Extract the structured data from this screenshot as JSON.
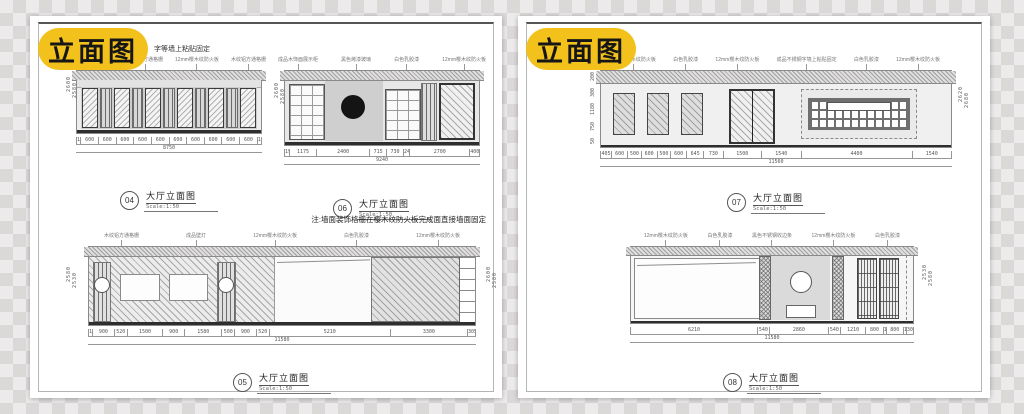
{
  "colors": {
    "badge_bg": "#F2C11B",
    "badge_text": "#161616",
    "paper": "#FFFFFF"
  },
  "left_page": {
    "badge": "立面图",
    "header_note": "字等墙上粘贴固定",
    "note": "注:墙面装饰格栅在樱木纹防火板完成面直接墙面固定",
    "drawing_04": {
      "number": "04",
      "title": "大厅立面图",
      "scale": "Scale:1:50",
      "dims": [
        "120",
        "600",
        "600",
        "600",
        "600",
        "600",
        "600",
        "600",
        "600",
        "600",
        "600",
        "120"
      ],
      "total_dim": "8750",
      "vdim_a": "2600",
      "vdim_b": "2580",
      "annotations": [
        "12mm樱木纹防火板",
        "木纹铝方通格栅",
        "12mm樱木纹防火板",
        "木纹铝方通格栅"
      ]
    },
    "drawing_06": {
      "number": "06",
      "title": "大厅立面图",
      "scale": "Scale:1:50",
      "dims": [
        "190",
        "1175",
        "2400",
        "715",
        "730",
        "240",
        "2700",
        "400"
      ],
      "total_dim": "9240",
      "vdim_a": "2600",
      "vdim_b": "2580",
      "annotations": [
        "成品木饰面展示柜",
        "黑色烤漆玻璃",
        "白色乳胶漆",
        "12mm樱木纹防火板"
      ]
    },
    "drawing_05": {
      "number": "05",
      "title": "大厅立面图",
      "scale": "Scale:1:50",
      "dims": [
        "130",
        "900",
        "520",
        "1500",
        "900",
        "1580",
        "500",
        "900",
        "520",
        "5210",
        "3300",
        "305"
      ],
      "total_dim": "11580",
      "vdim_left_a": "2580",
      "vdim_left_b": "2530",
      "vdim_right_a": "2600",
      "vdim_right_b": "2580",
      "annotations": [
        "木纹铝方通格栅",
        "成品壁灯",
        "12mm樱木纹防火板",
        "白色乳胶漆",
        "12mm樱木纹防火板"
      ]
    }
  },
  "right_page": {
    "badge": "立面图",
    "drawing_07": {
      "number": "07",
      "title": "大厅立面图",
      "scale": "Scale:1:50",
      "dims": [
        "405",
        "600",
        "500",
        "600",
        "500",
        "600",
        "645",
        "730",
        "1500",
        "1540",
        "4400",
        "1540"
      ],
      "total_dim": "11560",
      "vdims_left": [
        "200",
        "300",
        "1180",
        "750",
        "50"
      ],
      "vdim_a": "2620",
      "vdim_b": "2680",
      "annotations": [
        "12mm樱木纹防火板",
        "白色乳胶漆",
        "12mm樱木纹防火板",
        "成品不锈钢字墙上粘贴固定",
        "白色乳胶漆",
        "12mm樱木纹防火板"
      ]
    },
    "drawing_08": {
      "number": "08",
      "title": "大厅立面图",
      "scale": "Scale:1:50",
      "dims": [
        "6210",
        "540",
        "2860",
        "540",
        "1210",
        "800",
        "100",
        "800",
        "100",
        "300"
      ],
      "total_dim": "11580",
      "vdim_a": "2530",
      "vdim_b": "2580",
      "annotations": [
        "12mm樱木纹防火板",
        "白色乳胶漆",
        "黑色不锈钢收边条",
        "12mm樱木纹防火板",
        "白色乳胶漆"
      ]
    }
  }
}
